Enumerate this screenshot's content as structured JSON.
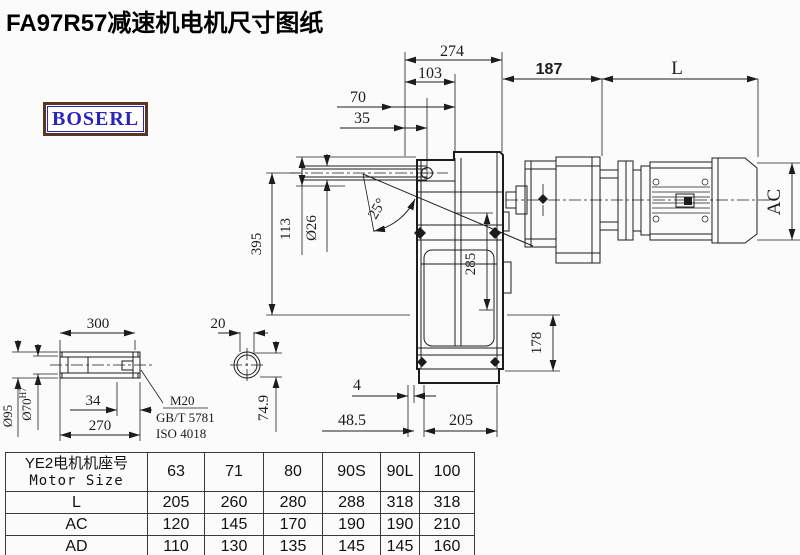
{
  "page": {
    "title": "FA97R57减速机电机尺寸图纸",
    "brand": "BOSERL"
  },
  "colors": {
    "line": "#1c1c1c",
    "logo_border": "#5a3523",
    "logo_text": "#2a23bd",
    "title": "#000000",
    "table_border": "#3a3a3a"
  },
  "drawing": {
    "labels": {
      "d274": "274",
      "d103": "103",
      "d70": "70",
      "d35": "35",
      "d187": "187",
      "L": "L",
      "AC": "AC",
      "d395": "395",
      "d113": "113",
      "dia26": "Ø26",
      "ang25": "25°",
      "d285": "285",
      "d178": "178",
      "d4": "4",
      "d48_5": "48.5",
      "d205": "205",
      "d300": "300",
      "dia95": "Ø95",
      "dia70": "Ø70",
      "dia70_tol": "H7",
      "d34": "34",
      "d270": "270",
      "m20": "M20",
      "gbt": "GB/T 5781",
      "iso": "ISO 4018",
      "d20": "20",
      "d74_9": "74.9"
    }
  },
  "table": {
    "corner_cn": "YE2电机机座号",
    "corner_en": "Motor Size",
    "columns": [
      "63",
      "71",
      "80",
      "90S",
      "90L",
      "100"
    ],
    "rows": [
      {
        "label": "L",
        "values": [
          "205",
          "260",
          "280",
          "288",
          "318",
          "318"
        ]
      },
      {
        "label": "AC",
        "values": [
          "120",
          "145",
          "170",
          "190",
          "190",
          "210"
        ]
      },
      {
        "label": "AD",
        "values": [
          "110",
          "130",
          "135",
          "145",
          "145",
          "160"
        ]
      }
    ]
  }
}
